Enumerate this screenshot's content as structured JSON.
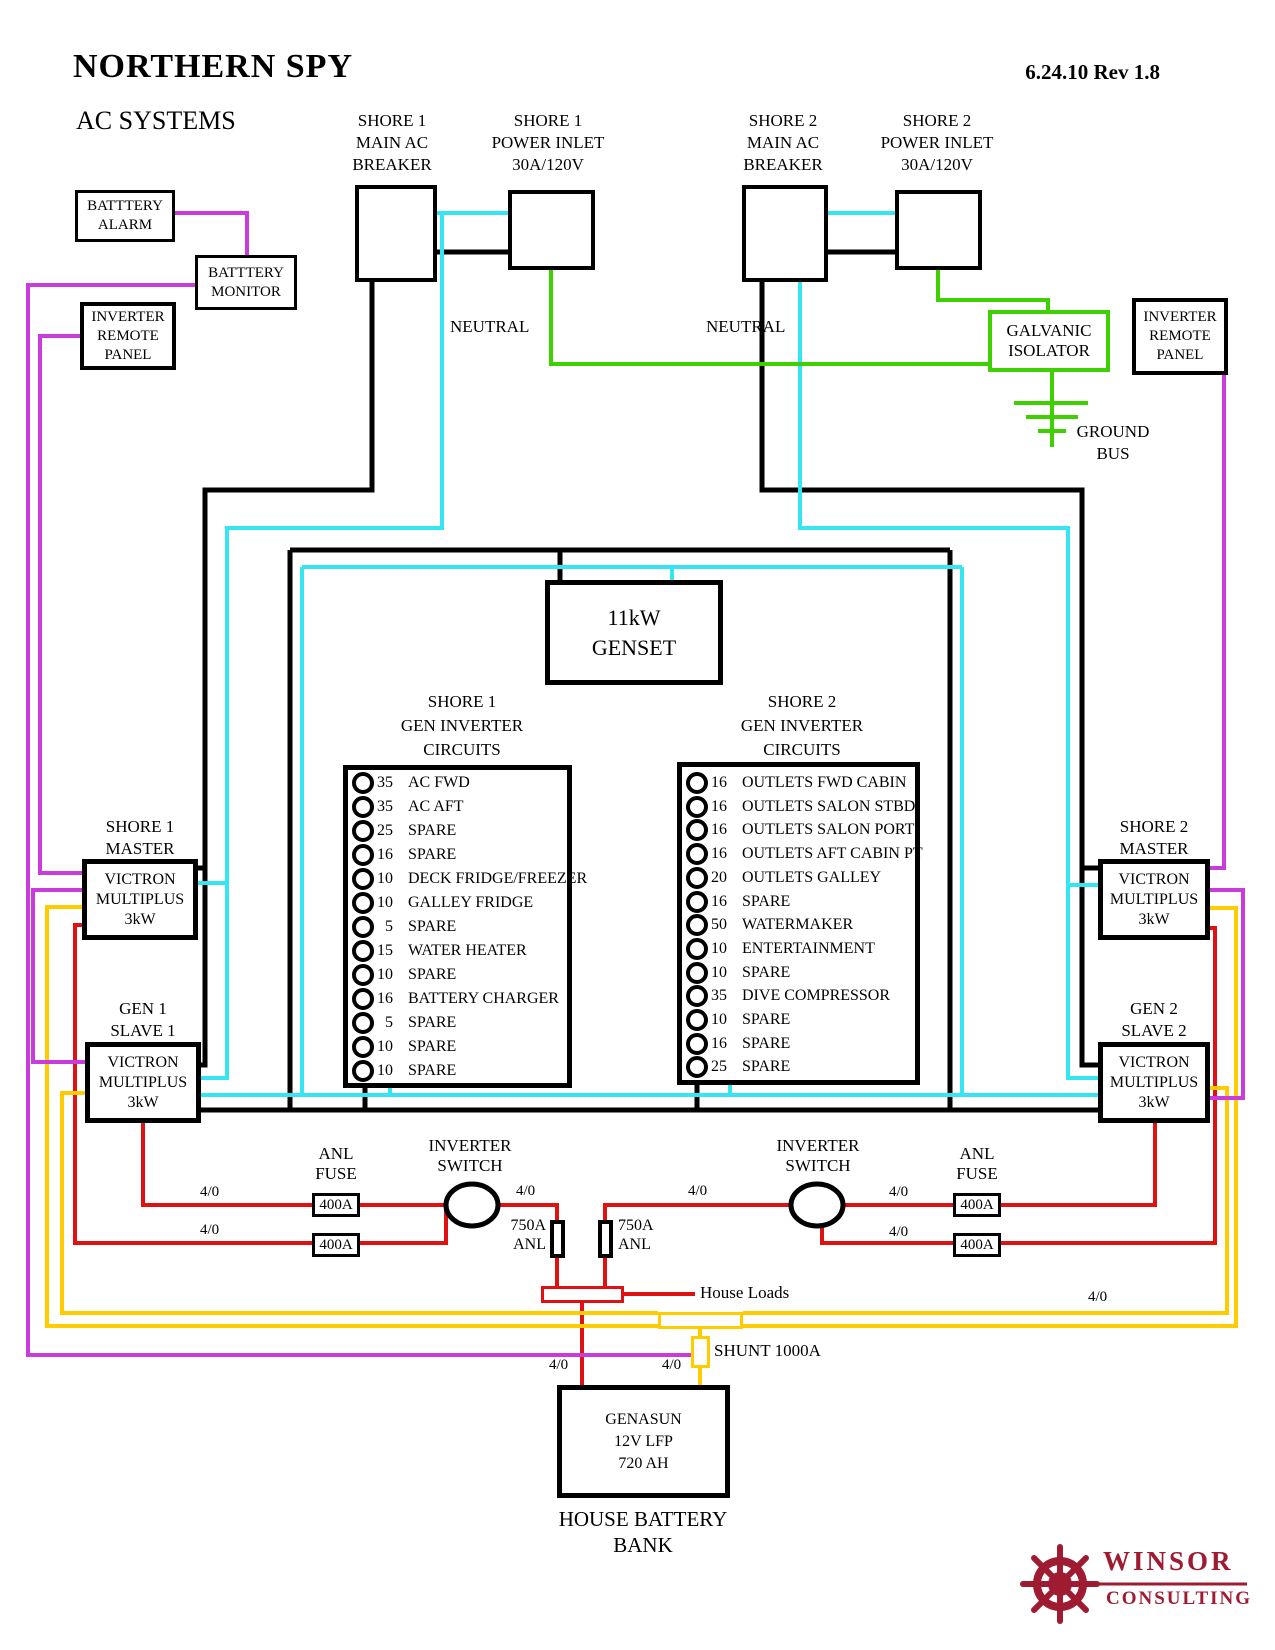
{
  "header": {
    "title": "NORTHERN SPY",
    "subtitle": "AC SYSTEMS",
    "revision": "6.24.10 Rev 1.8"
  },
  "colors": {
    "wire_hot": "#000000",
    "wire_neutral": "#35E6F2",
    "wire_ground": "#3ED000",
    "wire_dc_positive": "#DE1212",
    "wire_dc_negative": "#FFCC00",
    "wire_signal": "#C93BDB",
    "logo_maroon": "#9E1B32"
  },
  "top_labels": {
    "shore1_breaker": [
      "SHORE 1",
      "MAIN AC",
      "BREAKER"
    ],
    "shore1_inlet": [
      "SHORE 1",
      "POWER INLET",
      "30A/120V"
    ],
    "shore2_breaker": [
      "SHORE 2",
      "MAIN AC",
      "BREAKER"
    ],
    "shore2_inlet": [
      "SHORE 2",
      "POWER INLET",
      "30A/120V"
    ]
  },
  "neutral_label": "NEUTRAL",
  "boxes": {
    "battery_alarm": [
      "BATTTERY",
      "ALARM"
    ],
    "battery_monitor": [
      "BATTTERY",
      "MONITOR"
    ],
    "inverter_remote": [
      "INVERTER",
      "REMOTE",
      "PANEL"
    ],
    "galvanic_isolator": [
      "GALVANIC",
      "ISOLATOR"
    ],
    "ground_bus": [
      "GROUND",
      "BUS"
    ],
    "genset": [
      "11kW",
      "GENSET"
    ],
    "victron": [
      "VICTRON",
      "MULTIPLUS",
      "3kW"
    ],
    "genasun": [
      "GENASUN",
      "12V LFP",
      "720 AH"
    ],
    "house_battery": [
      "HOUSE BATTERY",
      "BANK"
    ]
  },
  "victron_labels": {
    "master1": [
      "SHORE 1",
      "MASTER"
    ],
    "slave1": [
      "GEN 1",
      "SLAVE 1"
    ],
    "master2": [
      "SHORE 2",
      "MASTER"
    ],
    "slave2": [
      "GEN 2",
      "SLAVE 2"
    ]
  },
  "panels": {
    "shore1": {
      "header": [
        "SHORE 1",
        "GEN INVERTER",
        "CIRCUITS"
      ],
      "circuits": [
        {
          "amps": "35",
          "label": "AC FWD"
        },
        {
          "amps": "35",
          "label": "AC AFT"
        },
        {
          "amps": "25",
          "label": "SPARE"
        },
        {
          "amps": "16",
          "label": "SPARE"
        },
        {
          "amps": "10",
          "label": "DECK FRIDGE/FREEZER"
        },
        {
          "amps": "10",
          "label": "GALLEY FRIDGE"
        },
        {
          "amps": "5",
          "label": "SPARE"
        },
        {
          "amps": "15",
          "label": "WATER HEATER"
        },
        {
          "amps": "10",
          "label": "SPARE"
        },
        {
          "amps": "16",
          "label": "BATTERY CHARGER"
        },
        {
          "amps": "5",
          "label": "SPARE"
        },
        {
          "amps": "10",
          "label": "SPARE"
        },
        {
          "amps": "10",
          "label": "SPARE"
        }
      ]
    },
    "shore2": {
      "header": [
        "SHORE 2",
        "GEN INVERTER",
        "CIRCUITS"
      ],
      "circuits": [
        {
          "amps": "16",
          "label": "OUTLETS FWD CABIN"
        },
        {
          "amps": "16",
          "label": "OUTLETS SALON STBD"
        },
        {
          "amps": "16",
          "label": "OUTLETS SALON PORT"
        },
        {
          "amps": "16",
          "label": "OUTLETS AFT CABIN PT"
        },
        {
          "amps": "20",
          "label": "OUTLETS GALLEY"
        },
        {
          "amps": "16",
          "label": "SPARE"
        },
        {
          "amps": "50",
          "label": "WATERMAKER"
        },
        {
          "amps": "10",
          "label": "ENTERTAINMENT"
        },
        {
          "amps": "10",
          "label": "SPARE"
        },
        {
          "amps": "35",
          "label": "DIVE COMPRESSOR"
        },
        {
          "amps": "10",
          "label": "SPARE"
        },
        {
          "amps": "16",
          "label": "SPARE"
        },
        {
          "amps": "25",
          "label": "SPARE"
        }
      ]
    }
  },
  "dc_section": {
    "anl_fuse_label": [
      "ANL",
      "FUSE"
    ],
    "fuse_400a": "400A",
    "inverter_switch_label": [
      "INVERTER",
      "SWITCH"
    ],
    "fuse_750a": [
      "750A",
      "ANL"
    ],
    "awg": "4/0",
    "house_loads": "House Loads",
    "shunt": "SHUNT 1000A"
  },
  "logo": {
    "line1": "WINSOR",
    "line2": "CONSULTING"
  }
}
